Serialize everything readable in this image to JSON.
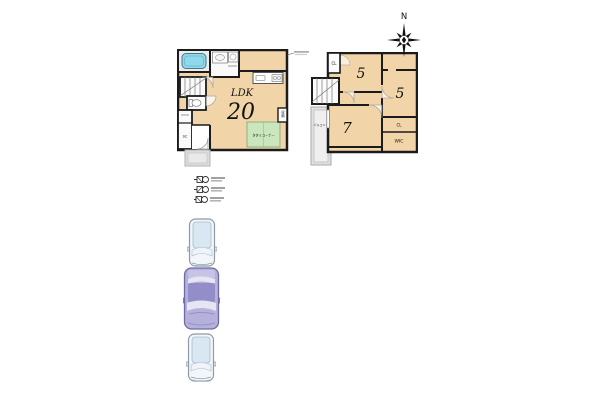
{
  "compass": {
    "north_label": "N"
  },
  "floor1": {
    "name_label": "LDK",
    "size_label": "20",
    "tatami_label": "タタミコーナー",
    "storage_label": "収納",
    "shoe_closet_label": "SC"
  },
  "floor2": {
    "bedroom_a_size": "5",
    "bedroom_b_size": "5",
    "bedroom_c_size": "7",
    "closet_a_label": "CL",
    "closet_b_label": "CL",
    "wic_label": "WIC",
    "balcony_label": "バルコニー"
  },
  "colors": {
    "room_fill": "#f1d5a8",
    "wall": "#1b1b1b",
    "tatami_green": "#c9e6bc",
    "bathtub_blue": "#8fd9ec",
    "balcony_gray": "#e0e0e0",
    "car_light_body": "#eef3f8",
    "car_purple_body": "#b5b1da"
  }
}
